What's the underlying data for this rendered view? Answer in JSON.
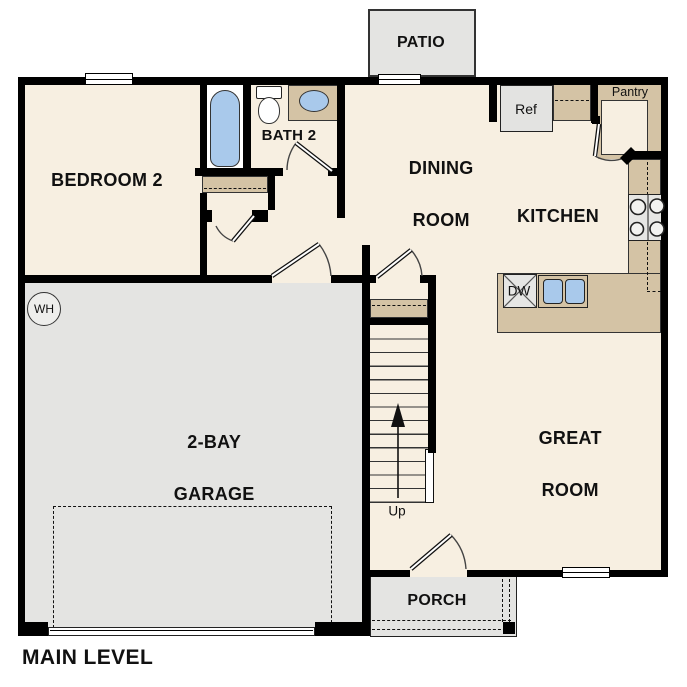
{
  "plan_title": "MAIN LEVEL",
  "rooms": {
    "patio": {
      "label": "PATIO"
    },
    "bedroom2": {
      "label": "BEDROOM 2"
    },
    "bath2": {
      "label": "BATH 2"
    },
    "dining_room": {
      "line1": "DINING",
      "line2": "ROOM"
    },
    "kitchen": {
      "label": "KITCHEN"
    },
    "pantry": {
      "label": "Pantry"
    },
    "great_room": {
      "line1": "GREAT",
      "line2": "ROOM"
    },
    "garage": {
      "line1": "2-BAY",
      "line2": "GARAGE"
    },
    "porch": {
      "label": "PORCH"
    }
  },
  "fixtures": {
    "refrigerator": "Ref",
    "dishwasher": "DW",
    "water_heater": "WH",
    "stairs_direction": "Up"
  },
  "colors": {
    "floor": "#f7efe1",
    "exterior_concrete": "#e4e4e2",
    "counter_tan": "#d4c3a5",
    "fixture_blue": "#a9c9eb",
    "wall": "#000000"
  }
}
